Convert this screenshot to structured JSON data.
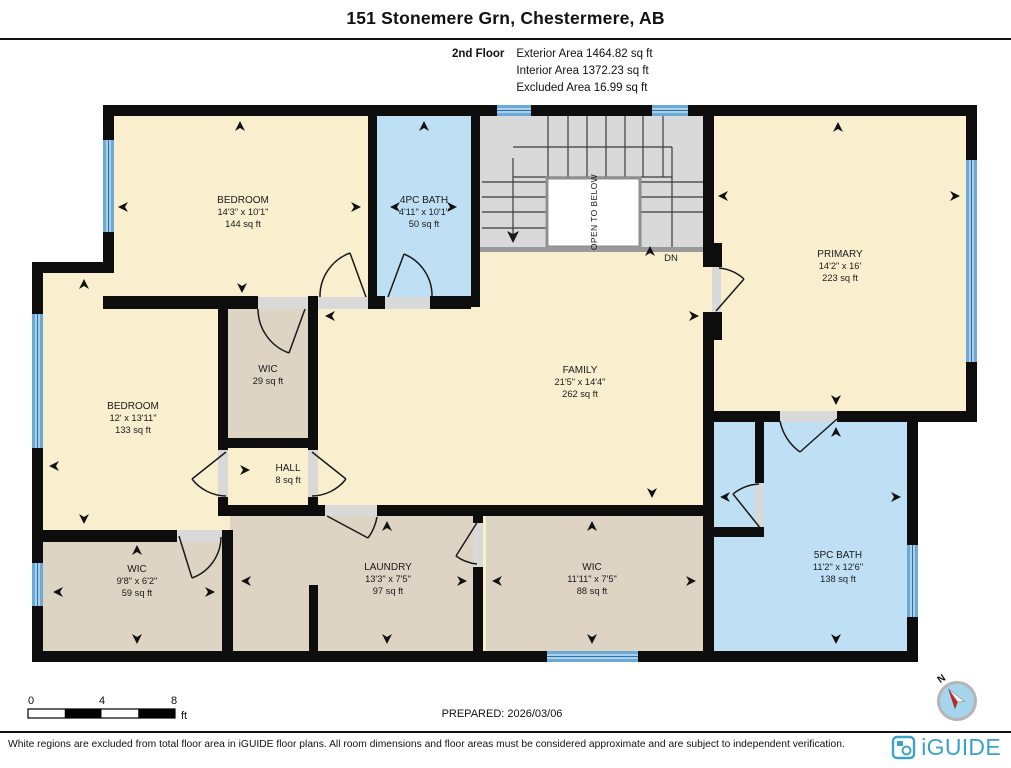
{
  "title": "151 Stonemere Grn, Chestermere, AB",
  "floor_info": {
    "floor_label": "2nd Floor",
    "exterior": "Exterior Area 1464.82 sq ft",
    "interior": "Interior Area 1372.23 sq ft",
    "excluded": "Excluded Area 16.99 sq ft"
  },
  "rooms": [
    {
      "name": "BEDROOM",
      "dims": "14'3\" x 10'1\"",
      "area": "144 sq ft"
    },
    {
      "name": "4PC BATH",
      "dims": "4'11\" x 10'1\"",
      "area": "50 sq ft"
    },
    {
      "name": "PRIMARY",
      "dims": "14'2\" x 16'",
      "area": "223 sq ft"
    },
    {
      "name": "BEDROOM",
      "dims": "12' x 13'11\"",
      "area": "133 sq ft"
    },
    {
      "name": "WIC",
      "area": "29 sq ft"
    },
    {
      "name": "FAMILY",
      "dims": "21'5\" x 14'4\"",
      "area": "262 sq ft"
    },
    {
      "name": "HALL",
      "area": "8 sq ft"
    },
    {
      "name": "WIC",
      "dims": "9'8\" x 6'2\"",
      "area": "59 sq ft"
    },
    {
      "name": "LAUNDRY",
      "dims": "13'3\" x 7'5\"",
      "area": "97 sq ft"
    },
    {
      "name": "WIC",
      "dims": "11'11\" x 7'5\"",
      "area": "88 sq ft"
    },
    {
      "name": "5PC BATH",
      "dims": "11'2\" x 12'6\"",
      "area": "138 sq ft"
    }
  ],
  "stairs": {
    "open_to_below": "OPEN TO BELOW",
    "down": "DN"
  },
  "scale_bar": {
    "tick_0": "0",
    "tick_4": "4",
    "tick_8": "8",
    "unit": "ft"
  },
  "prepared_label": "PREPARED: 2026/03/06",
  "compass": {
    "north": "N"
  },
  "footer": {
    "disclaimer": "White regions are excluded from total floor area in iGUIDE floor plans. All room dimensions and floor areas must be considered approximate and are subject to independent verification.",
    "brand": "iGUIDE"
  },
  "colors": {
    "room_fill": "#f9efcf",
    "closet_fill": "#ddd4c3",
    "bath_fill": "#bfe0f4",
    "stairs_fill": "#d9d9d9",
    "window_blue": "#5b9ecf",
    "wall_black": "#0d0d0d",
    "brand_teal": "#3ba3c8"
  }
}
